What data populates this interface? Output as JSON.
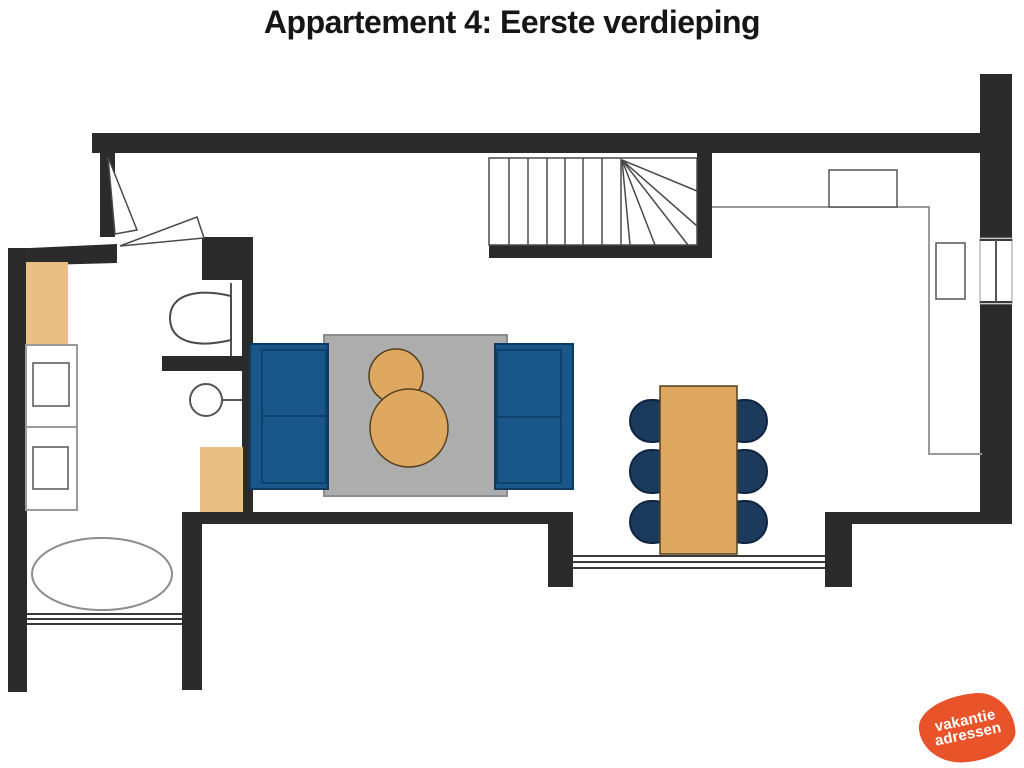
{
  "title": "Appartement 4: Eerste verdieping",
  "logo": {
    "line1": "vakantie",
    "line2": "adressen"
  },
  "floor_plan": {
    "language": "Dutch",
    "elements": [
      "entry-hall-with-two-door-leaves",
      "staircase-with-winder-steps",
      "kitchen-l-counter-with-cooktop-and-appliance",
      "right-wall-window",
      "bathroom-with-toilet-nook-washbasin-washer-dryer-oval-tub",
      "living-area-two-sofas-rug-two-round-tables",
      "dining-table-with-six-chairs",
      "bottom-sliding-window",
      "bathroom-bottom-window"
    ]
  },
  "colors": {
    "page_bg": "#ffffff",
    "title_color": "#161616",
    "wall": "#2b2b2b",
    "floor": "#ffffff",
    "sofa": "#19578a",
    "sofa_line": "#0d3a5e",
    "chair": "#1c3a5c",
    "chair_line": "#0f2440",
    "tan": "#dea861",
    "tan_line": "#54401f",
    "cabinet_tan": "#ebbe84",
    "rug": "#adadad",
    "rug_border": "#8c8c8c",
    "counter_line": "#9a9a9a",
    "fixture_line": "#555555",
    "stair_line": "#4a4a4a",
    "window_line": "#3a3a3a",
    "logo_orange": "#e9532a",
    "logo_text": "#ffffff"
  }
}
